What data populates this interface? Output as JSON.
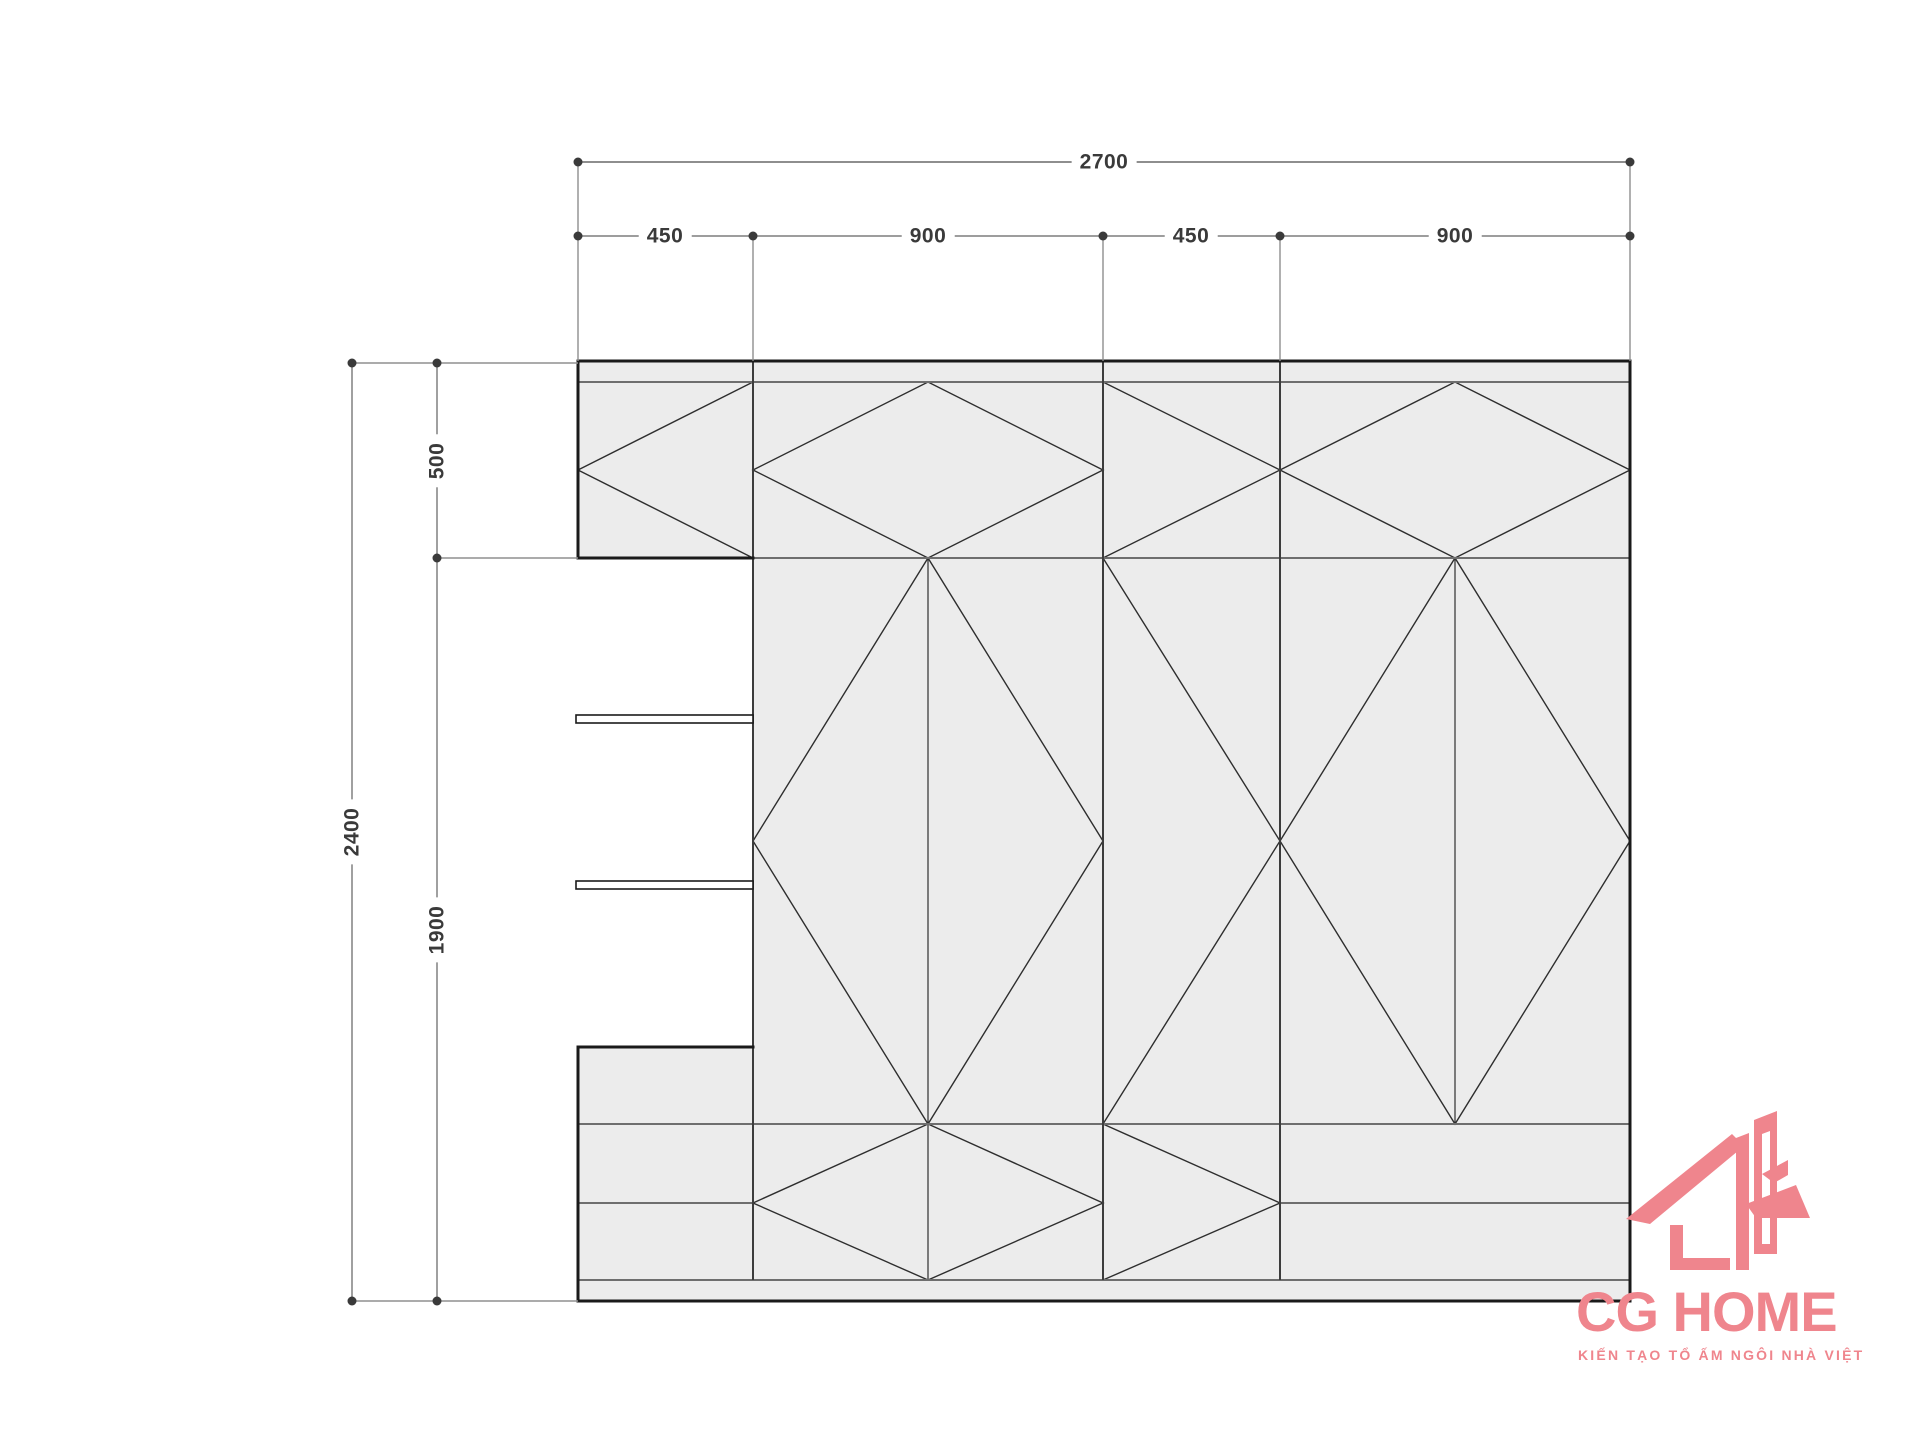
{
  "title": "wardrobe-elevation-technical-drawing",
  "dimensions": {
    "top_total": "2700",
    "top_segments": [
      "450",
      "900",
      "450",
      "900"
    ],
    "left_total": "2400",
    "left_segments": [
      "500",
      "1900"
    ]
  },
  "logo": {
    "name": "CG HOME",
    "tagline": "KIẾN TẠO TỔ ẤM NGÔI NHÀ VIỆT",
    "brand_color": "#ef858d"
  },
  "colors": {
    "background": "#ffffff",
    "panel_fill": "#ececec",
    "outline": "#1a1a1a",
    "divider": "#3c3c3c",
    "rail": "#6e6e6e",
    "diagonal": "#2e2e2e",
    "dimension_line": "#8f8f8f",
    "dimension_line_primary": "#4a4a4a",
    "dimension_text": "#3a3a3a"
  }
}
